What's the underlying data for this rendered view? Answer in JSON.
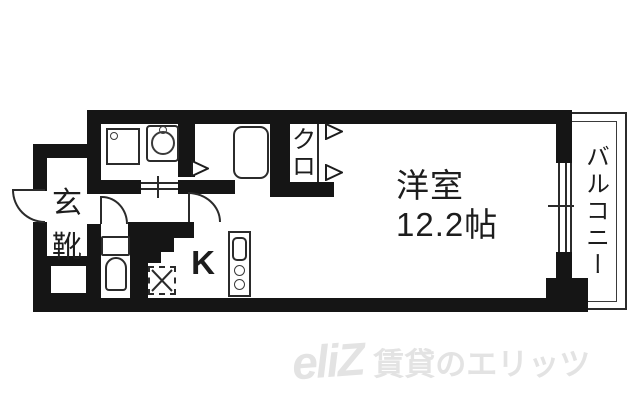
{
  "colors": {
    "wall": "#151515",
    "line": "#2b2b2b",
    "text": "#1d1d1d",
    "watermark": "#e3e3e3",
    "background": "#ffffff"
  },
  "floorplan": {
    "entrance": {
      "label_top": "玄",
      "label_bottom": "靴"
    },
    "closet": {
      "label": "クロ"
    },
    "kitchen": {
      "label": "K"
    },
    "main_room": {
      "name": "洋室",
      "size": "12.2帖"
    },
    "balcony": {
      "label": "バルコニー"
    }
  },
  "watermark": {
    "logo": "eliZ",
    "text": "賃貸のエリッツ"
  }
}
